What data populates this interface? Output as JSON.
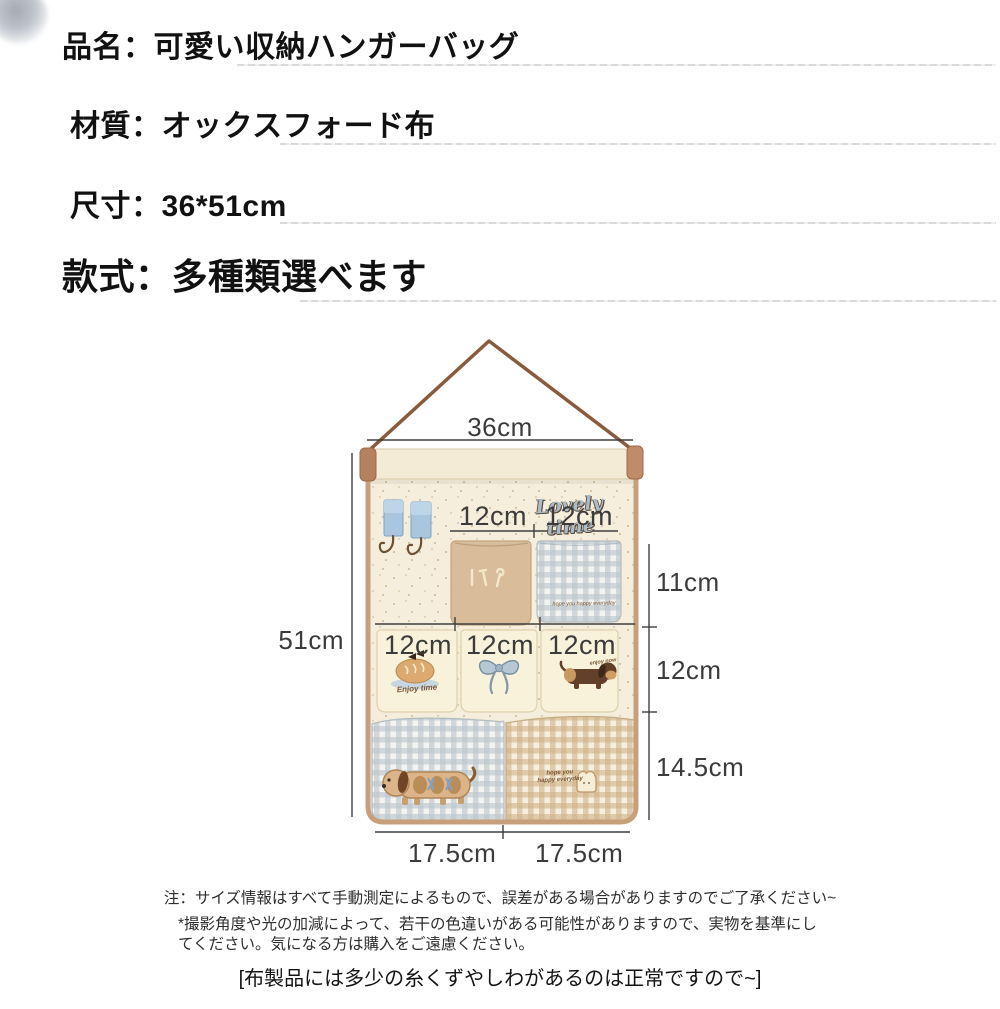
{
  "header": {
    "product_name": "品名：可愛い収納ハンガーバッグ",
    "material": "材質：オックスフォード布",
    "size": "尺寸：36*51cm",
    "style": "款式：多種類選べます"
  },
  "figure": {
    "brand_text": "Lovely time",
    "pocket_texts": {
      "small_gingham": "hope you happy everyday",
      "bread": "Enjoy time",
      "dog": "enjoy now",
      "large_gingham": "hope you\nhappy everyday"
    },
    "dimensions": {
      "top_width": "36cm",
      "left_height": "51cm",
      "row1": [
        "12cm",
        "12cm"
      ],
      "row2": [
        "12cm",
        "12cm",
        "12cm"
      ],
      "right": [
        "11cm",
        "12cm",
        "14.5cm"
      ],
      "bottom": [
        "17.5cm",
        "17.5cm"
      ]
    },
    "colors": {
      "fabric_cream": "#f6eedc",
      "pocket_tan": "#d9bd9a",
      "pocket_cream": "#f9f2db",
      "gingham_blue": "#b9c5cc",
      "gingham_tan": "#d0b288",
      "binding_brown": "#c79f7b",
      "strap_brown": "#8a5a3c",
      "hook_tab_blue": "#a9c6df",
      "dimension_line": "#3f3f3f"
    }
  },
  "notes": {
    "measurement": "注：サイズ情報はすべて手動測定によるもので、誤差がある場合がありますのでご了承ください~",
    "color_difference": "*撮影角度や光の加減によって、若干の色違いがある可能性がありますので、実物を基準にしてください。気になる方は購入をご遠慮ください。",
    "fabric": "[布製品には多少の糸くずやしわがあるのは正常ですので~]"
  }
}
